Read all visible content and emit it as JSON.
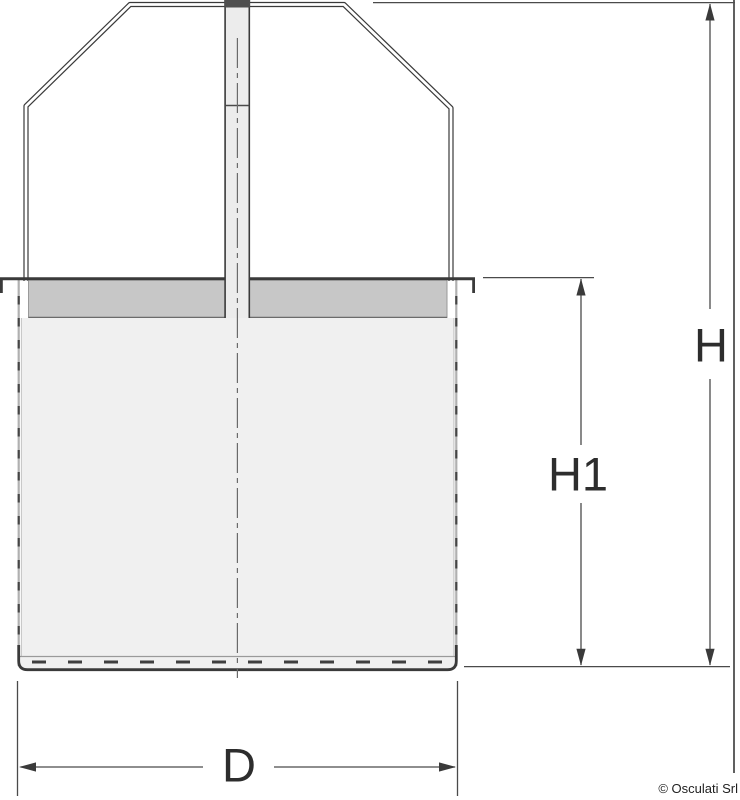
{
  "dimension_labels": {
    "overall_height": "H",
    "body_height": "H1",
    "diameter": "D"
  },
  "footer": {
    "copyright": "© Osculati Srl"
  },
  "colors": {
    "line_dark": "#3a3a3a",
    "line_medium": "#4a4a4a",
    "collar_fill": "#c7c7c7",
    "body_fill": "#f0f0f0",
    "stem_fill": "#ececec",
    "stem_cap_fill": "#4f4f4f",
    "label_text": "#2d2d2d"
  }
}
